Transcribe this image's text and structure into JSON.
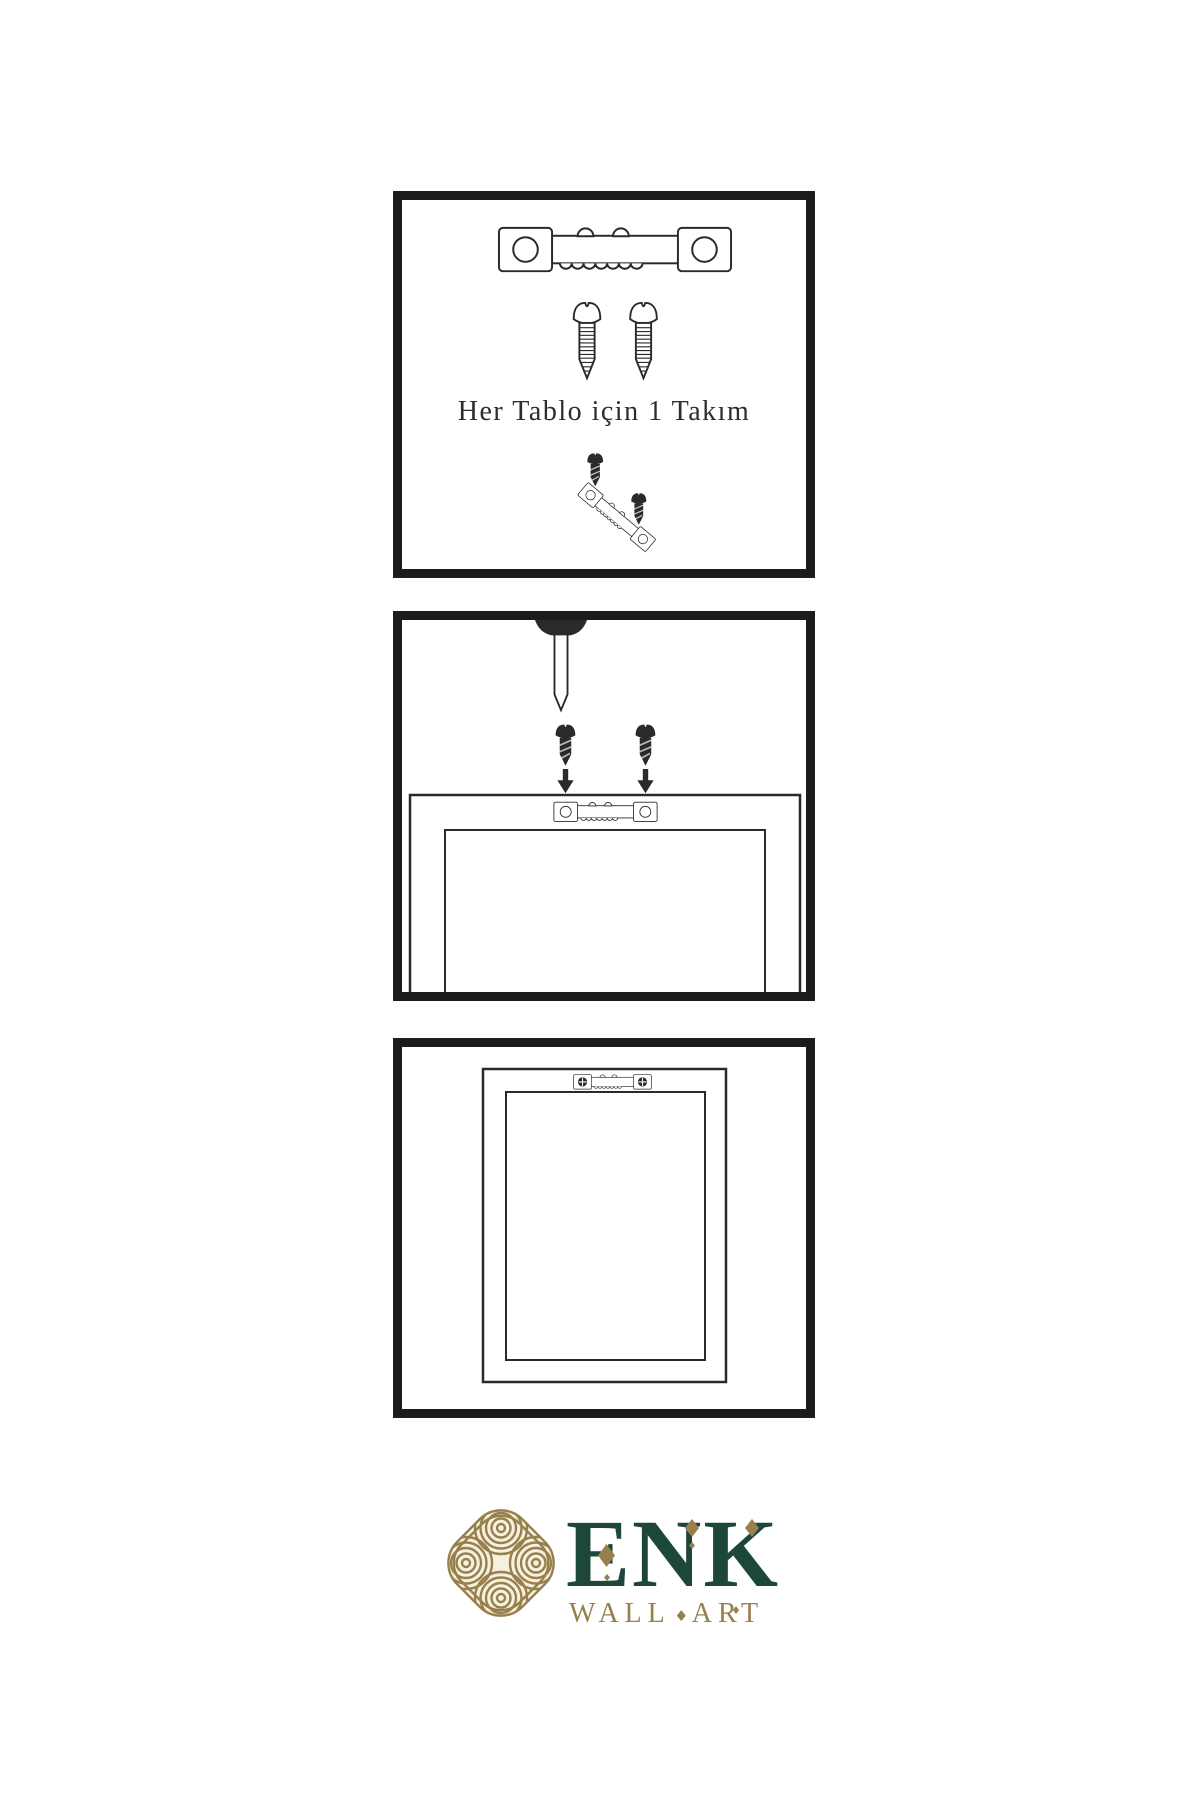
{
  "colors": {
    "background": "#ffffff",
    "line": "#2a2a2a",
    "panel_border": "#1c1c1c",
    "caption": "#2e2c2c",
    "gold": "#97804e",
    "green": "#1c473a",
    "cream": "#f6f0de"
  },
  "panels": [
    {
      "number": 1,
      "caption": "Her Tablo için 1 Takım",
      "shows": [
        "sawtooth-hanger-icon",
        "screw-icon",
        "screw-icon",
        "screws-attaching-to-tilted-hanger-icon"
      ]
    },
    {
      "number": 2,
      "shows": [
        "nail-in-wall-icon",
        "dark-screw-icon",
        "dark-screw-icon",
        "down-arrow-icon",
        "down-arrow-icon",
        "frame-back-with-sawtooth-hanger-icon"
      ]
    },
    {
      "number": 3,
      "shows": [
        "frame-back-icon",
        "installed-sawtooth-hanger-with-crosshead-screws-icon"
      ]
    }
  ],
  "brand": {
    "name": "ENK",
    "tagline_words": [
      "WALL",
      "ART"
    ],
    "icon": "interlaced-knot-icon"
  }
}
